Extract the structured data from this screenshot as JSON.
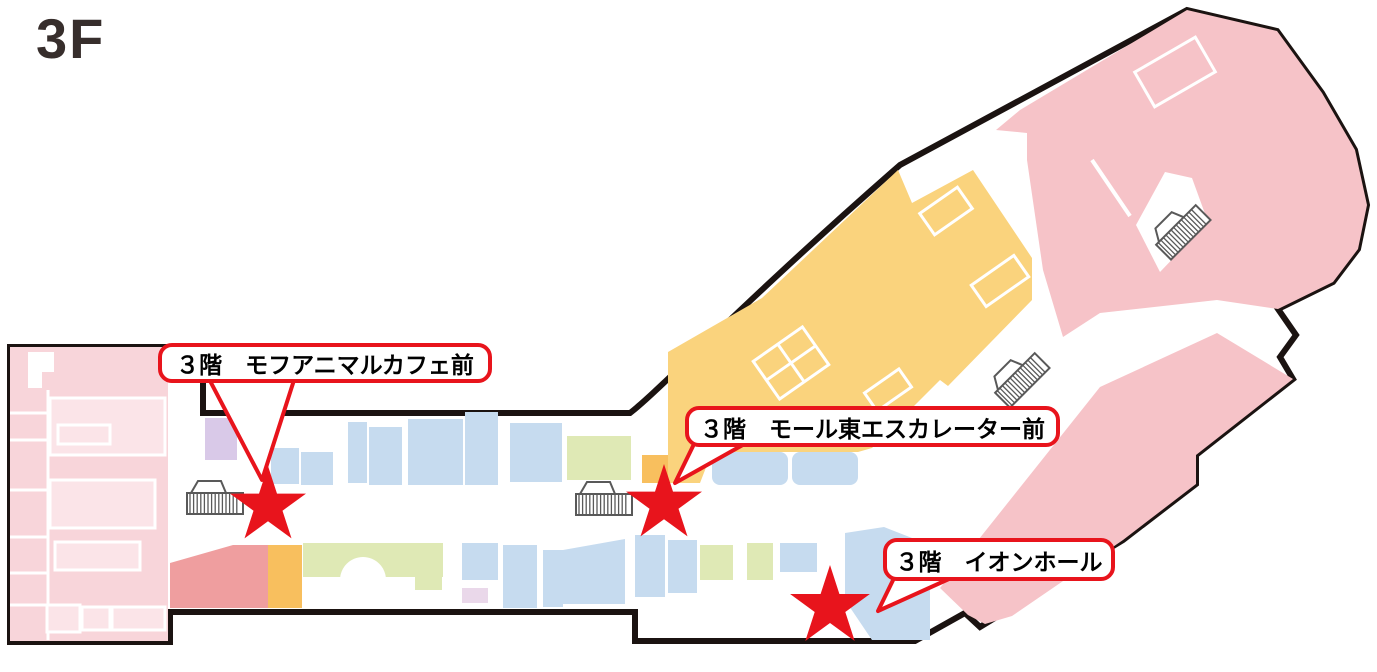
{
  "floor": {
    "label": "3F"
  },
  "callouts": [
    {
      "id": "mofu-animal-cafe",
      "text": "３階　モフアニマルカフェ前",
      "box": {
        "x": 158,
        "y": 343,
        "w": 334,
        "h": 40
      },
      "tail": {
        "x1": 208,
        "y1": 377,
        "x2": 295,
        "y2": 377,
        "ax": 262,
        "ay": 480
      }
    },
    {
      "id": "mall-east-escalator",
      "text": "３階　モール東エスカレーター前",
      "box": {
        "x": 685,
        "y": 406,
        "w": 375,
        "h": 41
      },
      "tail": {
        "x1": 695,
        "y1": 442,
        "x2": 748,
        "y2": 442,
        "ax": 675,
        "ay": 483
      }
    },
    {
      "id": "aeon-hall",
      "text": "３階　イオンホール",
      "box": {
        "x": 883,
        "y": 538,
        "w": 232,
        "h": 43
      },
      "tail": {
        "x1": 896,
        "y1": 574,
        "x2": 960,
        "y2": 574,
        "ax": 878,
        "ay": 611
      }
    }
  ],
  "stars": [
    {
      "for": "mofu-animal-cafe",
      "cx": 268,
      "cy": 506,
      "r": 40
    },
    {
      "for": "mall-east-escalator",
      "cx": 664,
      "cy": 504,
      "r": 40
    },
    {
      "for": "aeon-hall",
      "cx": 830,
      "cy": 607,
      "r": 42
    }
  ],
  "escalators": [
    {
      "x": 215,
      "y": 503,
      "rotation": 0
    },
    {
      "x": 604,
      "y": 504,
      "rotation": 0
    },
    {
      "x": 1022,
      "y": 380,
      "rotation": -45
    },
    {
      "x": 1183,
      "y": 232,
      "rotation": -45
    }
  ],
  "colors": {
    "red": "#e8141c",
    "outline": "#1b1311",
    "title": "#372e2c",
    "anchor_pink": "#f8d5da",
    "anchor_pink_light": "#fbe4e8",
    "wing_pink": "#f6c3c8",
    "salmon": "#ef9e9f",
    "orange": "#fad37d",
    "orange_deep": "#f8bf5e",
    "blue": "#c6dbef",
    "green": "#dfe9b5",
    "lavender": "#d9c9e8",
    "mauve": "#ead8ea",
    "icon_gray": "#595959"
  }
}
